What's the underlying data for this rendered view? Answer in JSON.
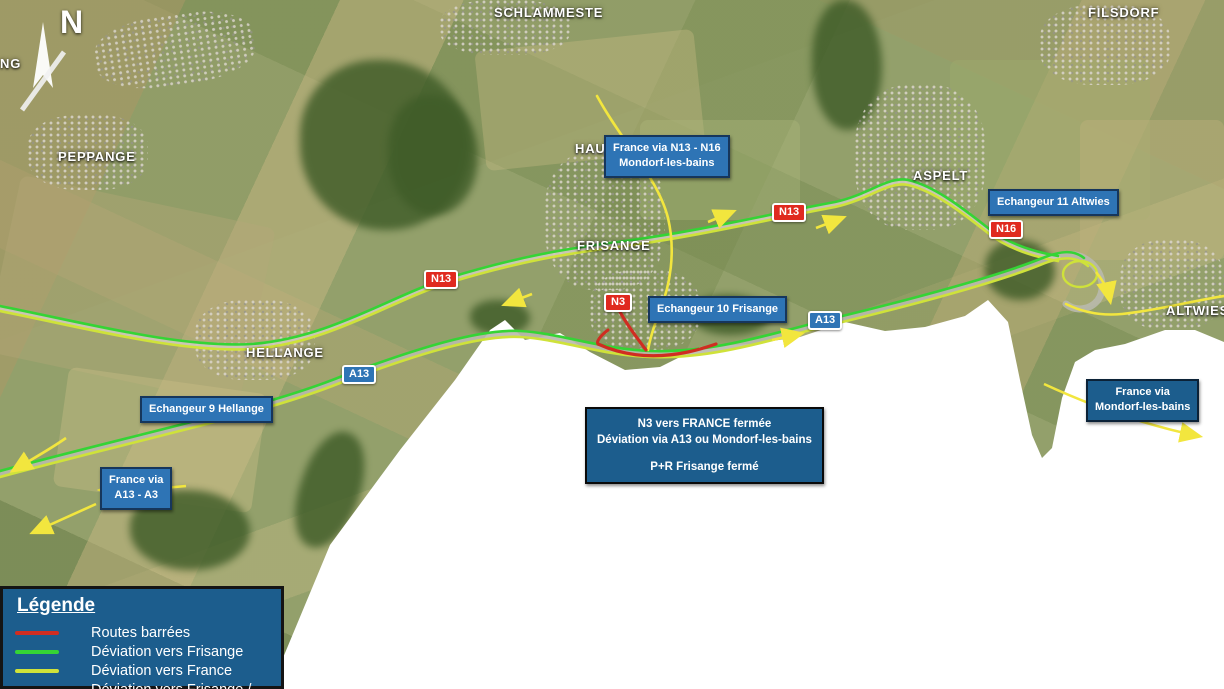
{
  "colors": {
    "road_closed": "#cf2d21",
    "dev_frisange": "#35d435",
    "dev_france": "#cfe23a",
    "arrow_yellow": "#f2e63e",
    "box_blue": "#2e74b5",
    "box_blue_dark": "#1c5d8d",
    "box_border": "#16365c",
    "badge_red": "#e02a1f",
    "badge_blue": "#2e74b5"
  },
  "compass": {
    "label": "N"
  },
  "places": {
    "peppange": "PEPPANGE",
    "schlammeste": "SCHLAMMESTE",
    "hau": "HAU",
    "frisange": "FRISANGE",
    "aspelt": "ASPELT",
    "filsdorf": "FILSDORF",
    "hellange": "HELLANGE",
    "altwies": "ALTWIES",
    "edge_partial": "NG"
  },
  "badges": {
    "n13_west": "N13",
    "n13_east": "N13",
    "n3": "N3",
    "n16": "N16",
    "a13_west": "A13",
    "a13_east": "A13"
  },
  "info_boxes": {
    "france_n13": {
      "line1": "France via N13 - N16",
      "line2": "Mondorf-les-bains"
    },
    "ech11": {
      "label": "Echangeur 11 Altwies"
    },
    "ech10": {
      "label": "Echangeur 10 Frisange"
    },
    "ech9": {
      "label": "Echangeur 9 Hellange"
    },
    "france_a13": {
      "line1": "France via",
      "line2": "A13 - A3"
    },
    "closure": {
      "line1": "N3 vers FRANCE fermée",
      "line2": "Déviation via A13 ou Mondorf-les-bains",
      "line3": "P+R Frisange fermé"
    },
    "france_mondorf": {
      "line1": "France via",
      "line2": "Mondorf-les-bains"
    }
  },
  "legend": {
    "title": "Légende",
    "items": [
      {
        "label": "Routes barrées",
        "swatch": "closed"
      },
      {
        "label": "Déviation vers Frisange",
        "swatch": "frisange"
      },
      {
        "label": "Déviation vers France",
        "swatch": "france"
      },
      {
        "label": "Déviation vers Frisange / France",
        "swatch": "mixed"
      }
    ]
  }
}
